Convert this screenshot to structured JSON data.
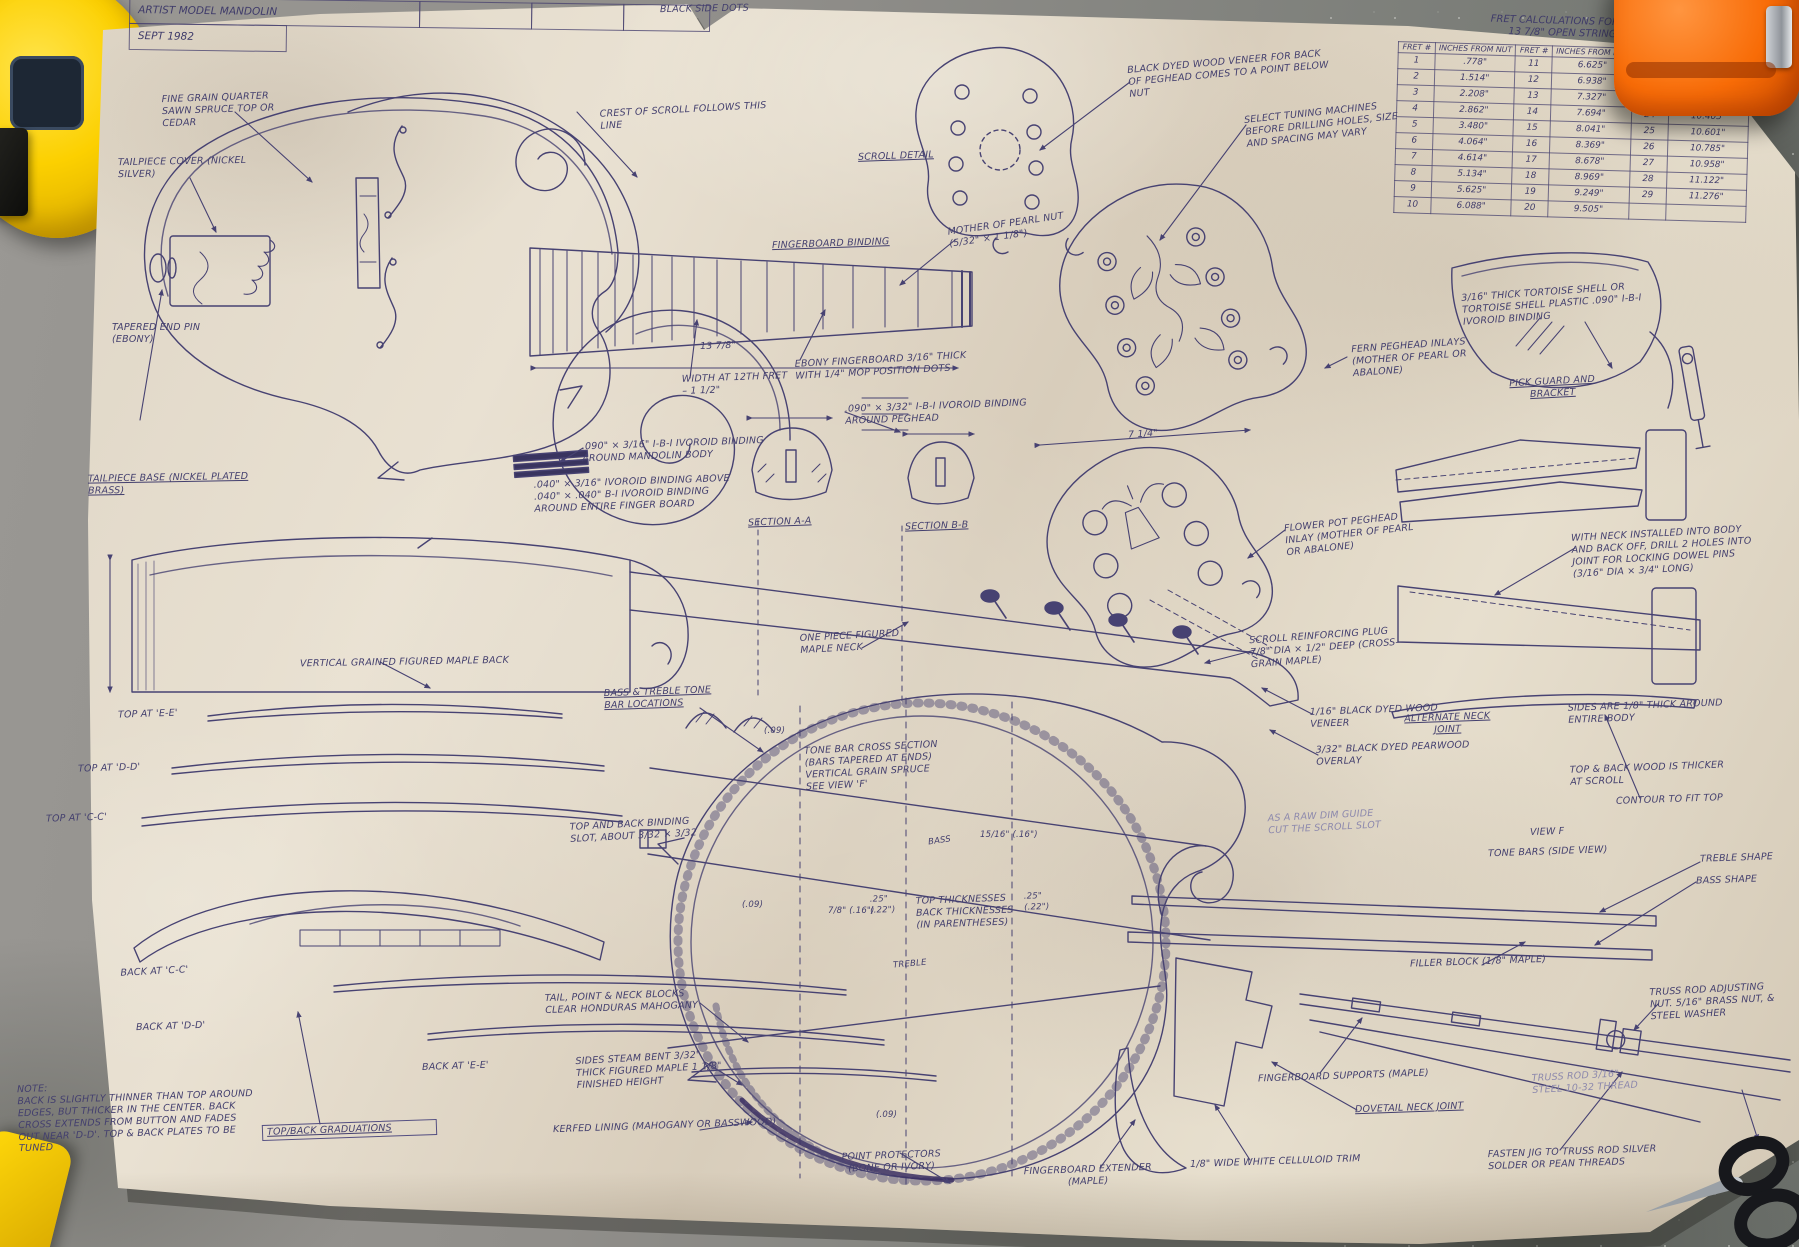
{
  "title_block": {
    "title": "ARTIST MODEL MANDOLIN",
    "date": "SEPT 1982"
  },
  "fret_table": {
    "title": "FRET CALCULATIONS FOR MANDOLIN",
    "subtitle": "13 7/8\" OPEN STRING LENGTH",
    "header_fret": "FRET #",
    "header_inches": "INCHES FROM NUT",
    "rows": [
      [
        "1",
        ".778\"",
        "11",
        "6.625\"",
        "21",
        "9.750\""
      ],
      [
        "2",
        "1.514\"",
        "12",
        "6.938\"",
        "22",
        "9.982\""
      ],
      [
        "3",
        "2.208\"",
        "13",
        "7.327\"",
        "23",
        "10.200\""
      ],
      [
        "4",
        "2.862\"",
        "14",
        "7.694\"",
        "24",
        "10.405\""
      ],
      [
        "5",
        "3.480\"",
        "15",
        "8.041\"",
        "25",
        "10.601\""
      ],
      [
        "6",
        "4.064\"",
        "16",
        "8.369\"",
        "26",
        "10.785\""
      ],
      [
        "7",
        "4.614\"",
        "17",
        "8.678\"",
        "27",
        "10.958\""
      ],
      [
        "8",
        "5.134\"",
        "18",
        "8.969\"",
        "28",
        "11.122\""
      ],
      [
        "9",
        "5.625\"",
        "19",
        "9.249\"",
        "29",
        "11.276\""
      ],
      [
        "10",
        "6.088\"",
        "20",
        "9.505\"",
        "",
        ""
      ]
    ]
  },
  "labels": {
    "black_side_dots": "BLACK SIDE DOTS",
    "fine_grain": "FINE GRAIN QUARTER SAWN SPRUCE TOP OR CEDAR",
    "tailpiece_cover": "TAILPIECE COVER (NICKEL SILVER)",
    "tapered_end_pin": "TAPERED END PIN (EBONY)",
    "tailpiece_base": "TAILPIECE BASE (NICKEL PLATED BRASS)",
    "crest_of_scroll": "CREST OF SCROLL FOLLOWS THIS LINE",
    "scroll_detail": "SCROLL DETAIL",
    "fingerboard_binding": "FINGERBOARD BINDING",
    "mop_nut": "MOTHER OF PEARL NUT (5/32\" × 1 1/8\")",
    "scale_length": "13 7/8\"",
    "width_12th_fret": "WIDTH AT 12TH FRET – 1 1/2\"",
    "ebony_fingerboard": "EBONY FINGERBOARD 3/16\" THICK WITH 1/4\" MOP POSITION DOTS",
    "peghead_veneer": "BLACK DYED WOOD VENEER FOR BACK OF PEGHEAD COMES TO A POINT BELOW NUT",
    "select_tuning": "SELECT TUNING MACHINES BEFORE DRILLING HOLES, SIZE AND SPACING MAY VARY",
    "peghead_binding": ".090\" × 3/32\" I-B-I IVOROID BINDING AROUND PEGHEAD",
    "body_binding": ".090\" × 3/16\" I-B-I IVOROID BINDING AROUND MANDOLIN BODY",
    "fingerboard_binding_spec": ".040\" × 3/16\" IVOROID BINDING ABOVE .040\" × .040\" B-I IVOROID BINDING AROUND ENTIRE FINGER BOARD",
    "section_aa": "SECTION A-A",
    "section_bb": "SECTION B-B",
    "peghead_width": "7 1/4\"",
    "fern_inlay": "FERN PEGHEAD INLAYS (MOTHER OF PEARL OR ABALONE)",
    "pickguard_material": "3/16\" THICK TORTOISE SHELL OR TORTOISE SHELL PLASTIC .090\" I-B-I IVOROID BINDING",
    "pickguard": "PICK GUARD AND BRACKET",
    "flowerpot": "FLOWER POT PEGHEAD INLAY (MOTHER OF PEARL OR ABALONE)",
    "dowel_pins": "WITH NECK INSTALLED INTO BODY AND BACK OFF, DRILL 2 HOLES INTO JOINT FOR LOCKING DOWEL PINS (3/16\" DIA × 3/4\" LONG)",
    "scroll_plug": "SCROLL REINFORCING PLUG 7/8\" DIA × 1/2\" DEEP (CROSS-GRAIN MAPLE)",
    "maple_back": "VERTICAL GRAINED FIGURED MAPLE BACK",
    "maple_neck": "ONE PIECE FIGURED MAPLE NECK",
    "black_veneer": "1/16\" BLACK DYED WOOD VENEER",
    "pearwood_overlay": "3/32\" BLACK DYED PEARWOOD OVERLAY",
    "alt_neck_joint": "ALTERNATE NECK JOINT",
    "sides_thickness": "SIDES ARE 1/8\" THICK AROUND ENTIRE BODY",
    "scroll_wood": "TOP & BACK WOOD IS THICKER AT SCROLL",
    "contour_fit": "CONTOUR TO FIT TOP",
    "view_f": "VIEW F",
    "tone_bars_side": "TONE BARS (SIDE VIEW)",
    "treble_shape": "TREBLE SHAPE",
    "bass_shape": "BASS SHAPE",
    "top_ee": "TOP AT 'E-E'",
    "top_dd": "TOP AT 'D-D'",
    "top_cc": "TOP AT 'C-C'",
    "back_cc": "BACK AT 'C-C'",
    "back_dd": "BACK AT 'D-D'",
    "back_ee": "BACK AT 'E-E'",
    "tone_bar_locations": "BASS & TREBLE TONE BAR LOCATIONS",
    "tone_bar_section": "TONE BAR CROSS SECTION (BARS TAPERED AT ENDS) VERTICAL GRAIN SPRUCE SEE VIEW 'F'",
    "binding_slot": "TOP AND BACK BINDING SLOT, ABOUT 3/32 × 3/32",
    "top_thicknesses": "TOP THICKNESSES BACK THICKNESSES (IN PARENTHESES)",
    "thickness_left": ".25\" (.22\")",
    "thickness_right": ".25\" (.22\")",
    "blocks": "TAIL, POINT & NECK BLOCKS CLEAR HONDURAS MAHOGANY",
    "sides_steam": "SIDES STEAM BENT 3/32\" THICK FIGURED MAPLE 1 1/8\" FINISHED HEIGHT",
    "note": "NOTE:\nBACK IS SLIGHTLY THINNER THAN TOP AROUND EDGES, BUT THICKER IN THE CENTER. BACK CROSS EXTENDS FROM BUTTON AND FADES OUT NEAR 'D-D'. TOP & BACK PLATES TO BE TUNED",
    "graduations": "TOP/BACK GRADUATIONS",
    "kerfed": "KERFED LINING (MAHOGANY OR BASSWOOD)",
    "point_protectors": "POINT PROTECTORS (BONE OR IVORY)",
    "fb_extender": "FINGERBOARD EXTENDER (MAPLE)",
    "celluloid_trim": "1/8\" WIDE WHITE CELLULOID TRIM",
    "fb_supports": "FINGERBOARD SUPPORTS (MAPLE)",
    "dovetail": "DOVETAIL NECK JOINT",
    "fasten_jig": "FASTEN JIG TO TRUSS ROD SILVER SOLDER OR PEAN THREADS",
    "filler_block": "FILLER BLOCK (1/8\" MAPLE)",
    "truss_nut": "TRUSS ROD ADJUSTING NUT. 5/16\" BRASS NUT, & STEEL WASHER",
    "truss_rod": "TRUSS ROD 3/16\" STEEL 10-32 THREAD",
    "scroll_slot_note": "AS A RAW DIM GUIDE CUT THE SCROLL SLOT",
    "bass_text": "BASS",
    "treble_text": "TREBLE",
    "dim_09": "(.09)",
    "dim_78": "7/8\" (.16\")",
    "dim_1516": "15/16\" (.16\")"
  }
}
